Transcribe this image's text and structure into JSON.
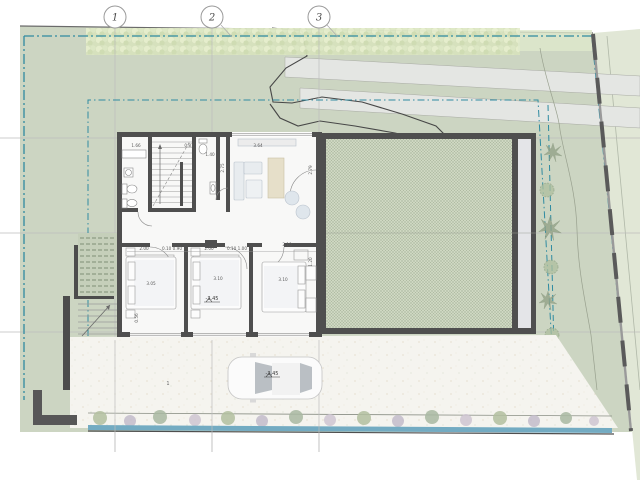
{
  "plan": {
    "grid": {
      "bubbles": [
        "1",
        "2",
        "3"
      ]
    },
    "levels": {
      "bedroom": "-3.45",
      "driveway": "-3.45"
    },
    "driveway_label": "1",
    "dims": {
      "bath1_top": "1.66",
      "stair_top": "0.87",
      "living_top": "3.64",
      "bath2_side": "1.40",
      "hall_side": "2.75",
      "living_side": "2.79",
      "bed1_a": "2.00",
      "bed1_b": "0.10 0.90",
      "bed2_a": "2.00",
      "bed2_b": "0.10 1.00",
      "bed3_top": "2.10",
      "bed1_len": "3.05",
      "bed2_len": "3.10",
      "bed3_len": "3.10",
      "bed3_side": "1.20",
      "bed1_side": "0.56"
    },
    "colors": {
      "site_green": "#ccd5c2",
      "hedge_green": "#dde7c3",
      "boundary_blue": "#2f8ba1",
      "wall_gray": "#4f4f4f",
      "hatch_green": "#9fae92",
      "water_blue": "#73abc2",
      "driveway": "#f5f4ef",
      "path_band": "#e4e6e3",
      "counter_tan": "#e6dfc9"
    }
  }
}
